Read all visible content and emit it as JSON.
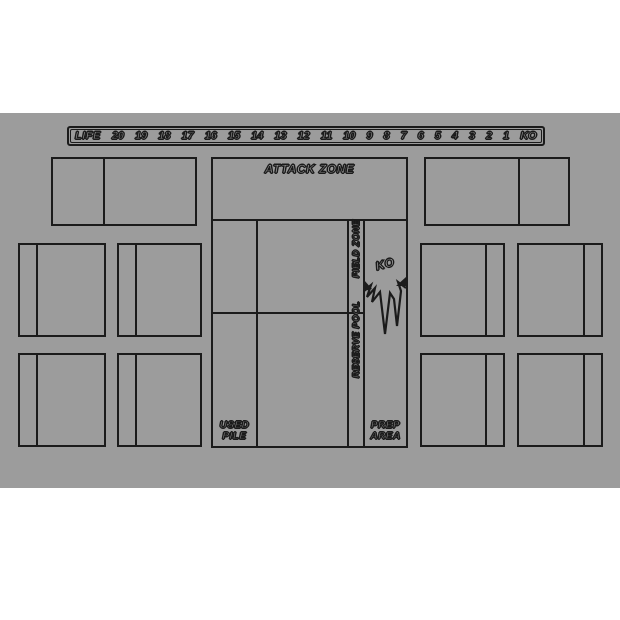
{
  "colors": {
    "page_background": "#ffffff",
    "mat_background": "#9c9c9c",
    "line": "#1b1b1b",
    "label_fill": "#ababab"
  },
  "life_track": {
    "label": "LIFE",
    "values": [
      "20",
      "19",
      "18",
      "17",
      "16",
      "15",
      "14",
      "13",
      "12",
      "11",
      "10",
      "9",
      "8",
      "7",
      "6",
      "5",
      "4",
      "3",
      "2",
      "1",
      "KO"
    ]
  },
  "zones": {
    "attack_zone_label": "ATTACK ZONE",
    "field_zone_label": "FIELD ZONE",
    "reserve_pool_label": "RESERVE POOL",
    "ko_label": "KO",
    "used_pile_label_line1": "USED",
    "used_pile_label_line2": "PILE",
    "prep_area_label_line1": "PREP",
    "prep_area_label_line2": "AREA"
  }
}
